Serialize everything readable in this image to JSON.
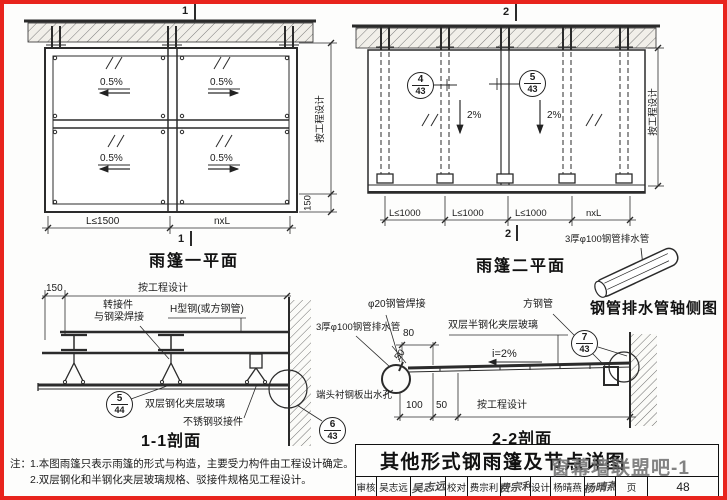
{
  "plan1": {
    "title": "雨篷一平面",
    "section_marker": "1",
    "slopes": [
      "0.5%",
      "0.5%",
      "0.5%",
      "0.5%"
    ],
    "dim_right": "按工程设计",
    "dim_150": "150",
    "dim_bottom_left": "L≤1500",
    "dim_bottom_right": "nxL"
  },
  "plan2": {
    "title": "雨篷二平面",
    "section_marker": "2",
    "slopes": [
      "2%",
      "2%"
    ],
    "ref_left": {
      "num": "4",
      "sheet": "43"
    },
    "ref_right": {
      "num": "5",
      "sheet": "43"
    },
    "dims_bottom": [
      "L≤1000",
      "L≤1000",
      "L≤1000",
      "nxL"
    ],
    "dim_right": "按工程设计"
  },
  "pipe_axon": {
    "label": "3厚φ100钢管排水管",
    "title": "钢管排水管轴侧图"
  },
  "section11": {
    "title": "1-1剖面",
    "dim_150": "150",
    "dim_design": "按工程设计",
    "label_adapter_1": "转接件",
    "label_adapter_2": "与钢梁焊接",
    "label_hsteel": "H型钢(或方钢管)",
    "label_glass": "双层钢化夹层玻璃",
    "label_spider": "不锈钢驳接件",
    "ref": {
      "num": "5",
      "sheet": "44"
    }
  },
  "section22": {
    "title": "2-2剖面",
    "label_pipe_weld": "φ20钢管焊接",
    "label_square_tube": "方钢管",
    "label_glass": "双层半钢化夹层玻璃",
    "label_drain": "3厚φ100钢管排水管",
    "label_slope": "i=2%",
    "label_outlet": "端头衬钢板出水孔",
    "dim_80": "80",
    "dim_50_diag": "50",
    "dim_100": "100",
    "dim_50": "50",
    "dim_design": "按工程设计",
    "ref_wall": {
      "num": "7",
      "sheet": "43"
    },
    "ref_outlet": {
      "num": "6",
      "sheet": "43"
    }
  },
  "notes": {
    "prefix": "注：",
    "line1": "1.本图雨篷只表示雨篷的形式与构造，主要受力构件由工程设计确定。",
    "line2": "2.双层钢化和半钢化夹层玻璃规格、驳接件规格见工程设计。"
  },
  "titleblock": {
    "title": "其他形式钢雨篷及节点详图",
    "watermark": "窗幕墙联盟吧-1",
    "cells": [
      {
        "label": "审核",
        "name": "吴志远",
        "sig": "吴志远"
      },
      {
        "label": "校对",
        "name": "费宗利",
        "sig": "费宗利"
      },
      {
        "label": "设计",
        "name": "杨晴燕",
        "sig": "杨晴燕"
      }
    ],
    "page_label": "页",
    "page_number": "48"
  }
}
